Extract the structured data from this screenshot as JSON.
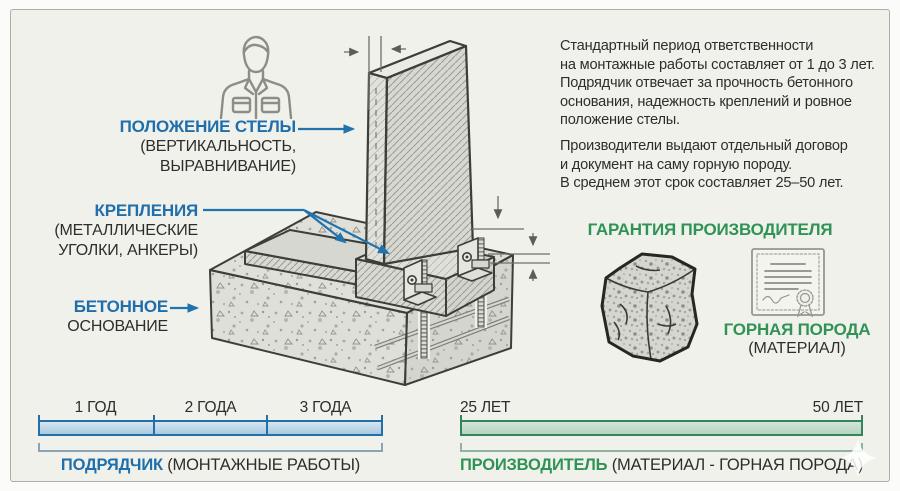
{
  "callouts": {
    "stele": {
      "title": "ПОЛОЖЕНИЕ СТЕЛЫ",
      "sub1": "(ВЕРТИКАЛЬНОСТЬ,",
      "sub2": "ВЫРАВНИВАНИЕ)"
    },
    "fasteners": {
      "title": "КРЕПЛЕНИЯ",
      "sub1": "(МЕТАЛЛИЧЕСКИЕ",
      "sub2": "УГОЛКИ, АНКЕРЫ)"
    },
    "foundation": {
      "title": "БЕТОННОЕ",
      "sub": "ОСНОВАНИЕ"
    }
  },
  "info": {
    "p1": [
      "Стандартный период ответственности",
      "на монтажные работы составляет от 1 до 3 лет.",
      "Подрядчик отвечает за прочность бетонного",
      "основания, надежность креплений и ровное",
      "положение стелы."
    ],
    "p2": [
      "Производители выдают отдельный договор",
      "и документ на саму горную породу.",
      "В среднем этот срок составляет 25–50 лет."
    ]
  },
  "warranty": {
    "title": "ГАРАНТИЯ ПРОИЗВОДИТЕЛЯ",
    "material": "ГОРНАЯ ПОРОДА",
    "material_note": "(МАТЕРИАЛ)"
  },
  "timeline_contractor": {
    "ticks": [
      "1 ГОД",
      "2 ГОДА",
      "3 ГОДА"
    ],
    "caption_bold": "ПОДРЯДЧИК",
    "caption_rest": " (МОНТАЖНЫЕ РАБОТЫ)"
  },
  "timeline_manufacturer": {
    "start": "25 ЛЕТ",
    "end": "50 ЛЕТ",
    "caption_bold": "ПРОИЗВОДИТЕЛЬ",
    "caption_rest": " (МАТЕРИАЛ - ГОРНАЯ ПОРОДА)"
  },
  "colors": {
    "accent_blue": "#1f6fad",
    "accent_green": "#2f9356",
    "bar_blue_border": "#2470a6",
    "bar_green_border": "#35855c",
    "text_dark": "#2d2d2b",
    "background": "#f1f1ec"
  },
  "icons": {
    "worker": "worker-icon",
    "stone": "stone-cube-icon",
    "certificate": "certificate-icon",
    "sparkle": "sparkle-icon"
  }
}
